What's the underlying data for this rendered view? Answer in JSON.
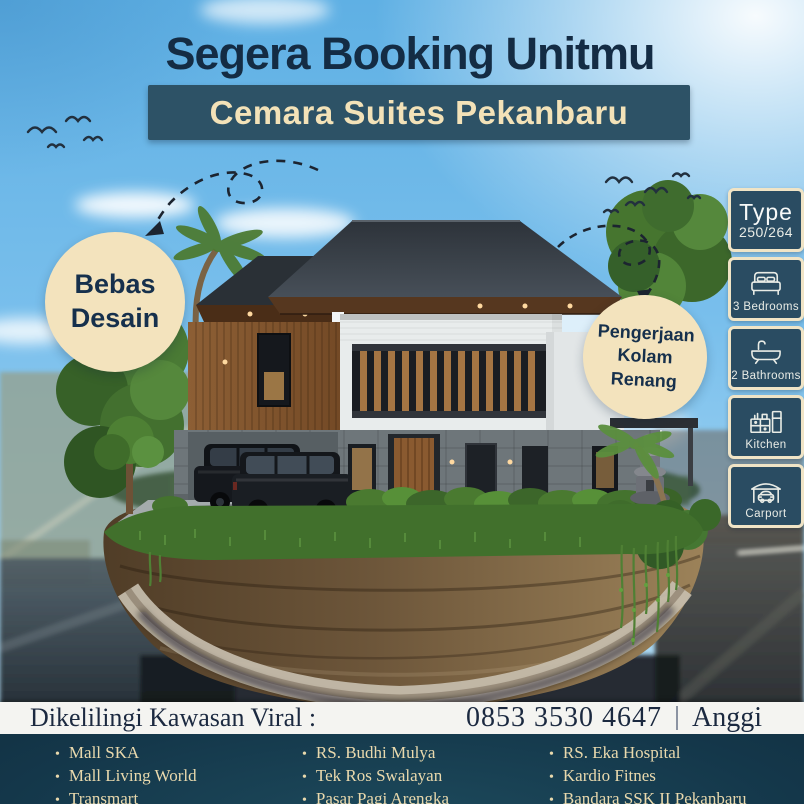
{
  "poster": {
    "title": "Segera Booking Unitmu",
    "subtitle": "Cemara Suites Pekanbaru"
  },
  "badges": {
    "design": {
      "line1": "Bebas",
      "line2": "Desain"
    },
    "pool": {
      "line1": "Pengerjaan",
      "line2": "Kolam Renang"
    }
  },
  "spec_panel": {
    "type_label": "Type",
    "type_value": "250/264",
    "items": [
      {
        "icon": "bed-icon",
        "label": "3 Bedrooms"
      },
      {
        "icon": "bathtub-icon",
        "label": "2 Bathrooms"
      },
      {
        "icon": "kitchen-icon",
        "label": "Kitchen"
      },
      {
        "icon": "carport-icon",
        "label": "Carport"
      }
    ]
  },
  "info_bar": {
    "heading": "Dikelilingi Kawasan Viral :",
    "phone": "0853 3530 4647",
    "contact_name": "Anggi"
  },
  "locations": {
    "columns": [
      [
        "Mall SKA",
        "Mall Living World",
        "Transmart"
      ],
      [
        "RS. Budhi Mulya",
        "Tek Ros Swalayan",
        "Pasar Pagi Arengka"
      ],
      [
        "RS. Eka Hospital",
        "Kardio Fitnes",
        "Bandara SSK II Pekanbaru"
      ]
    ]
  },
  "colors": {
    "navy_text": "#142c44",
    "teal_panel": "#2d5266",
    "cream": "#f3e3bd",
    "sky_blue": "#79bfec",
    "panel_tile": "#2a4c62",
    "bottom_bg": "#0d2634",
    "list_text": "#e9d9ad",
    "info_strip_bg": "#f4f4f1"
  }
}
